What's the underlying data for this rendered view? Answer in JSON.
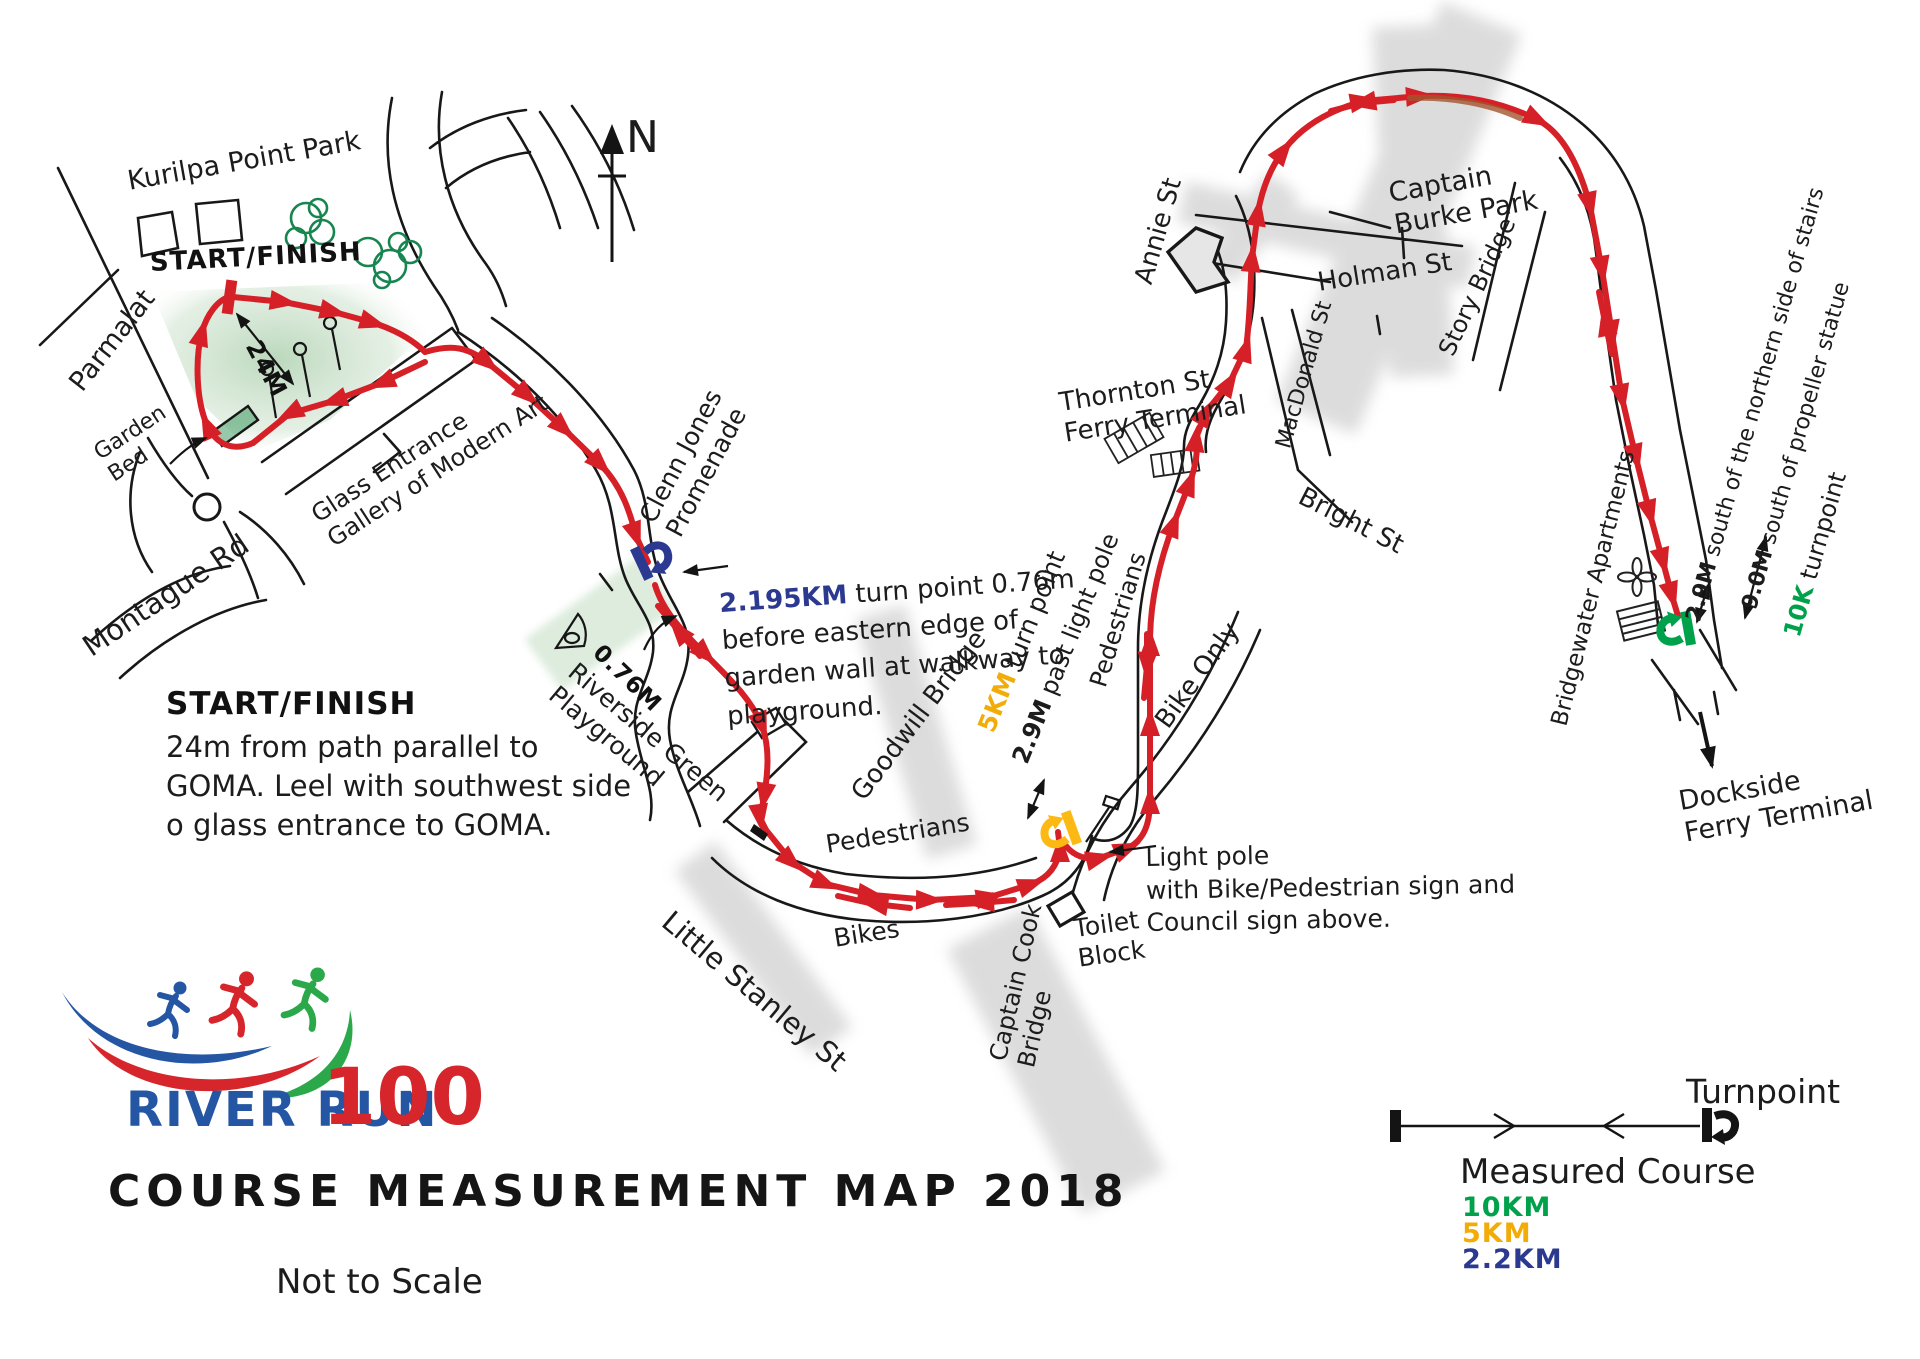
{
  "colors": {
    "route_red": "#d62027",
    "turnpoint_blue": "#2b3990",
    "turnpoint_yellow": "#fdb913",
    "turnpoint_green": "#00a14b",
    "tree_green": "#17854f",
    "bridge_gray": "#d9d9d9"
  },
  "compass": {
    "north_label": "N"
  },
  "map_labels": {
    "kurilpa": "Kurilpa Point Park",
    "start_finish": "START/FINISH",
    "parmalat": "Parmalat",
    "garden_bed": "Garden\nBed",
    "montague_rd": "Montague Rd",
    "glass_entrance": "Glass Entrance\nGallery of Modern Art",
    "clenn_jones": "Clenn Jones\nPromenade",
    "riverside_green": "Riverside Green\nPlayground",
    "little_stanley": "Little Stanley St",
    "goodwill_bridge": "Goodwill Bridge",
    "pedestrians_south": "Pedestrians",
    "bikes": "Bikes",
    "pedestrians_east": "Pedestrians",
    "bike_only": "Bike Only",
    "captain_cook": "Captain Cook\nBridge",
    "toilet_block": "Toilet\nBlock",
    "annie_st": "Annie St",
    "holman_st": "Holman St",
    "thornton_ferry": "Thornton St\nFerry Terminal",
    "macdonald_st": "MacDonald St",
    "bright_st": "Bright St",
    "story_bridge": "Story Bridge",
    "captain_burke": "Captain\nBurke Park",
    "bridgewater": "Bridgewater Apartments",
    "dockside_ferry": "Dockside\nFerry Terminal"
  },
  "annotations": {
    "start_note_heading": "START/FINISH",
    "start_note_body": "24m from path parallel to\nGOMA. Leel with southwest side\no glass entrance to GOMA.",
    "meas_24m": "24M",
    "meas_076m": "0.76M",
    "turn_2195": {
      "km": "2.195KM",
      "text": " turn point 0.76m\nbefore eastern edge of\ngarden wall at walkway to\nplayground."
    },
    "turn_5k": {
      "km": "5KM",
      "text": " turn point"
    },
    "past_light_pole": {
      "m": "2.9M",
      "text": " past light pole"
    },
    "light_pole_note": "Light pole\nwith Bike/Pedestrian sign and\nCouncil sign above.",
    "stairs_note": {
      "m": "2.9M",
      "text": " south of the northern side of stairs"
    },
    "propeller_note": {
      "m": "9.0M",
      "text": " south of propeller statue"
    },
    "turn_10k": {
      "km": "10K",
      "text": " turnpoint"
    }
  },
  "logo": {
    "river_run": "RIVER RUN",
    "hundred": "100"
  },
  "footer": {
    "title": "COURSE MEASUREMENT MAP 2018",
    "scale_note": "Not to Scale"
  },
  "legend": {
    "turnpoint": "Turnpoint",
    "measured_course": "Measured Course",
    "distances": [
      {
        "label": "10KM",
        "color": "#00a14b"
      },
      {
        "label": "5KM",
        "color": "#fdb913"
      },
      {
        "label": "2.2KM",
        "color": "#2b3990"
      }
    ]
  }
}
